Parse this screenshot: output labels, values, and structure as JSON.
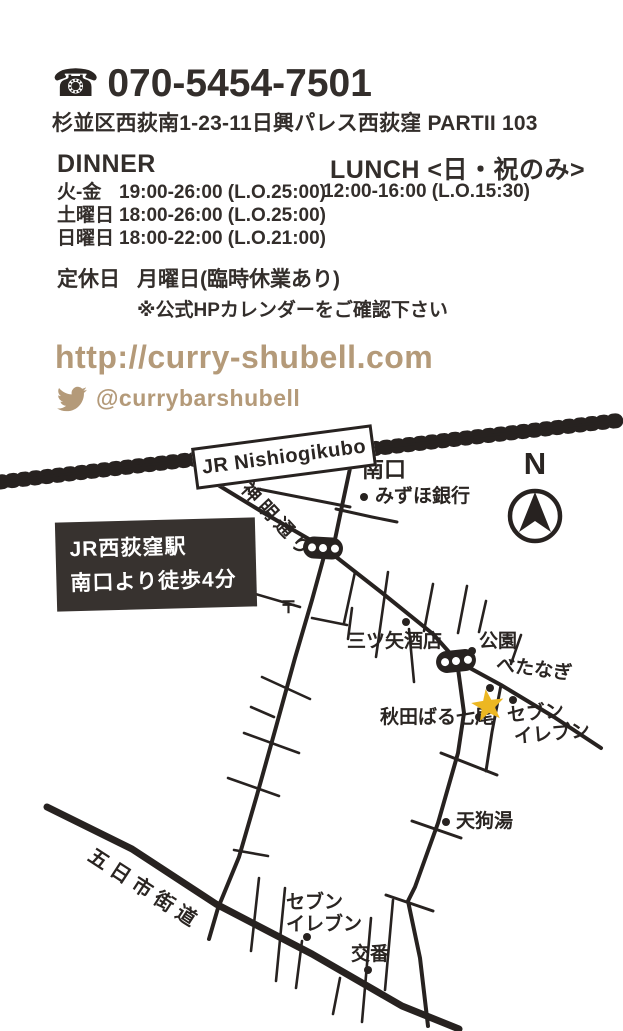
{
  "contact": {
    "phone_icon": "☎",
    "phone": "070-5454-7501",
    "address": "杉並区西荻南1-23-11日興パレス西荻窪 PARTII 103"
  },
  "hours": {
    "dinner": {
      "label": "DINNER",
      "rows": [
        {
          "days": "火-金",
          "time": "19:00-26:00 (L.O.25:00)"
        },
        {
          "days": "土曜日",
          "time": "18:00-26:00 (L.O.25:00)"
        },
        {
          "days": "日曜日",
          "time": "18:00-22:00 (L.O.21:00)"
        }
      ]
    },
    "lunch": {
      "label": "LUNCH <日・祝のみ>",
      "time": "12:00-16:00 (L.O.15:30)"
    },
    "closed": {
      "label": "定休日",
      "value": "月曜日(臨時休業あり)",
      "note": "※公式HPカレンダーをご確認下さい"
    }
  },
  "links": {
    "website": "http://curry-shubell.com",
    "twitter": "@currybarshubell"
  },
  "map": {
    "station_sign": "JR Nishiogikubo",
    "access_box": {
      "line1": "JR西荻窪駅",
      "line2": "南口より徒歩4分"
    },
    "compass_n": "N",
    "labels": {
      "south_exit": "南口",
      "mizuho_bank": "みずほ銀行",
      "shinmei_dori": "神明通り",
      "post_office": "〒",
      "mitsuya_liquor": "三ツ矢酒店",
      "park": "公園",
      "betanagi": "べたなぎ",
      "akita_bar_nanao": "秋田ばる七尾",
      "seven_eleven_upper_line1": "セブン",
      "seven_eleven_upper_line2": "イレブン",
      "tengu_bath": "天狗湯",
      "itsukaichi_kaido": "五日市街道",
      "seven_eleven_lower_line1": "セブン",
      "seven_eleven_lower_line2": "イレブン",
      "police_box": "交番"
    }
  },
  "colors": {
    "text": "#332e2b",
    "line": "#272220",
    "accent_tan": "#b49a79",
    "star_gold": "#ecb722",
    "box_dark": "#37322f"
  }
}
